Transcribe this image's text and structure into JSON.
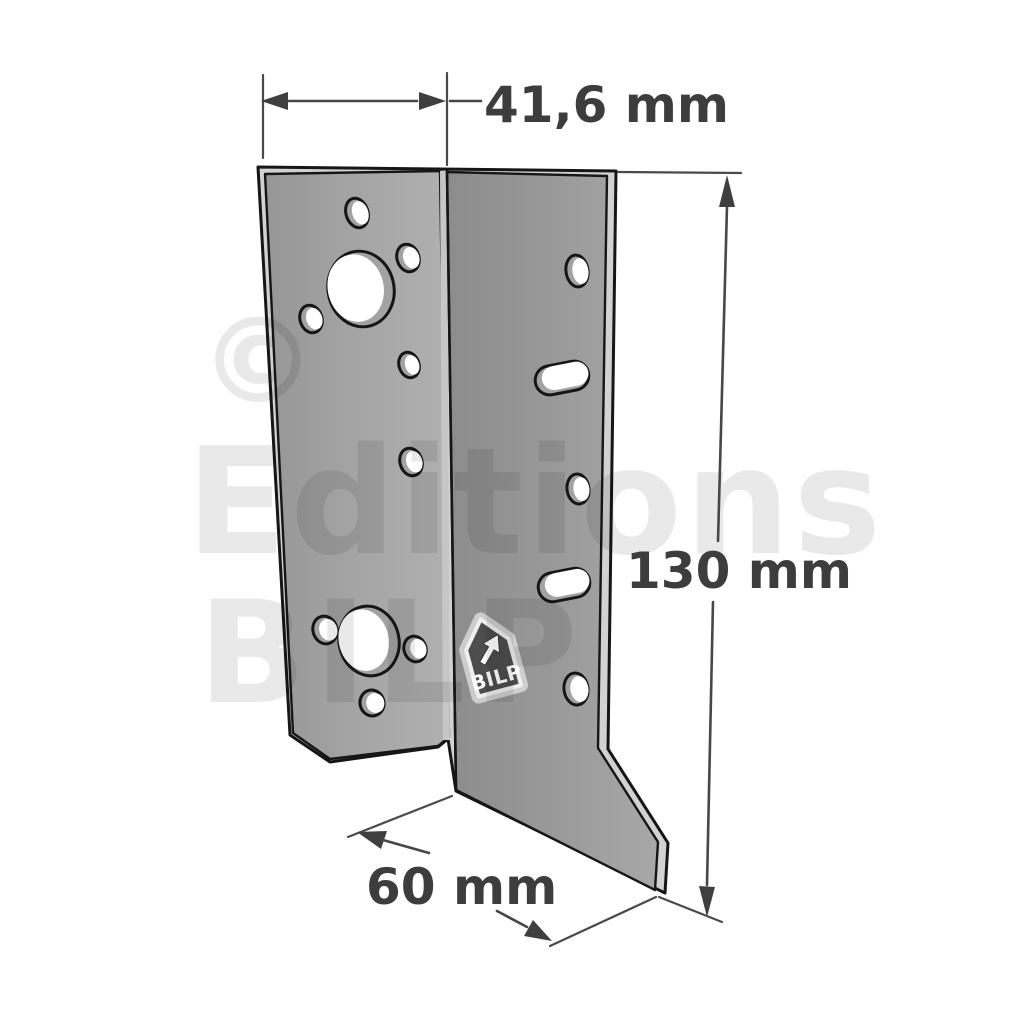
{
  "image": {
    "type": "technical-product-diagram",
    "subject": "sheet-metal angle bracket with nail holes and slots",
    "background": "#ffffff"
  },
  "dimensions": {
    "top_width": "41,6 mm",
    "right_height": "130 mm",
    "bottom_depth": "60 mm"
  },
  "watermark": {
    "copyright_symbol": "©",
    "line1": "Editions",
    "line2": "BILP"
  },
  "logo": {
    "text": "BILP",
    "icon": "cursor-arrow"
  },
  "colors": {
    "annotation": "#3d3d3d",
    "line": "#474747",
    "plate_face_left": "#989898",
    "plate_face_left_light": "#aeaeae",
    "plate_face_right": "#8c8c8c",
    "plate_face_right_light": "#a6a6a6",
    "edge_highlight": "#d2d2d2",
    "outline": "#161616",
    "watermark_tint": "rgba(0,0,0,0.085)",
    "logo_fill": "#4d4d4d",
    "logo_border": "#efefef"
  }
}
